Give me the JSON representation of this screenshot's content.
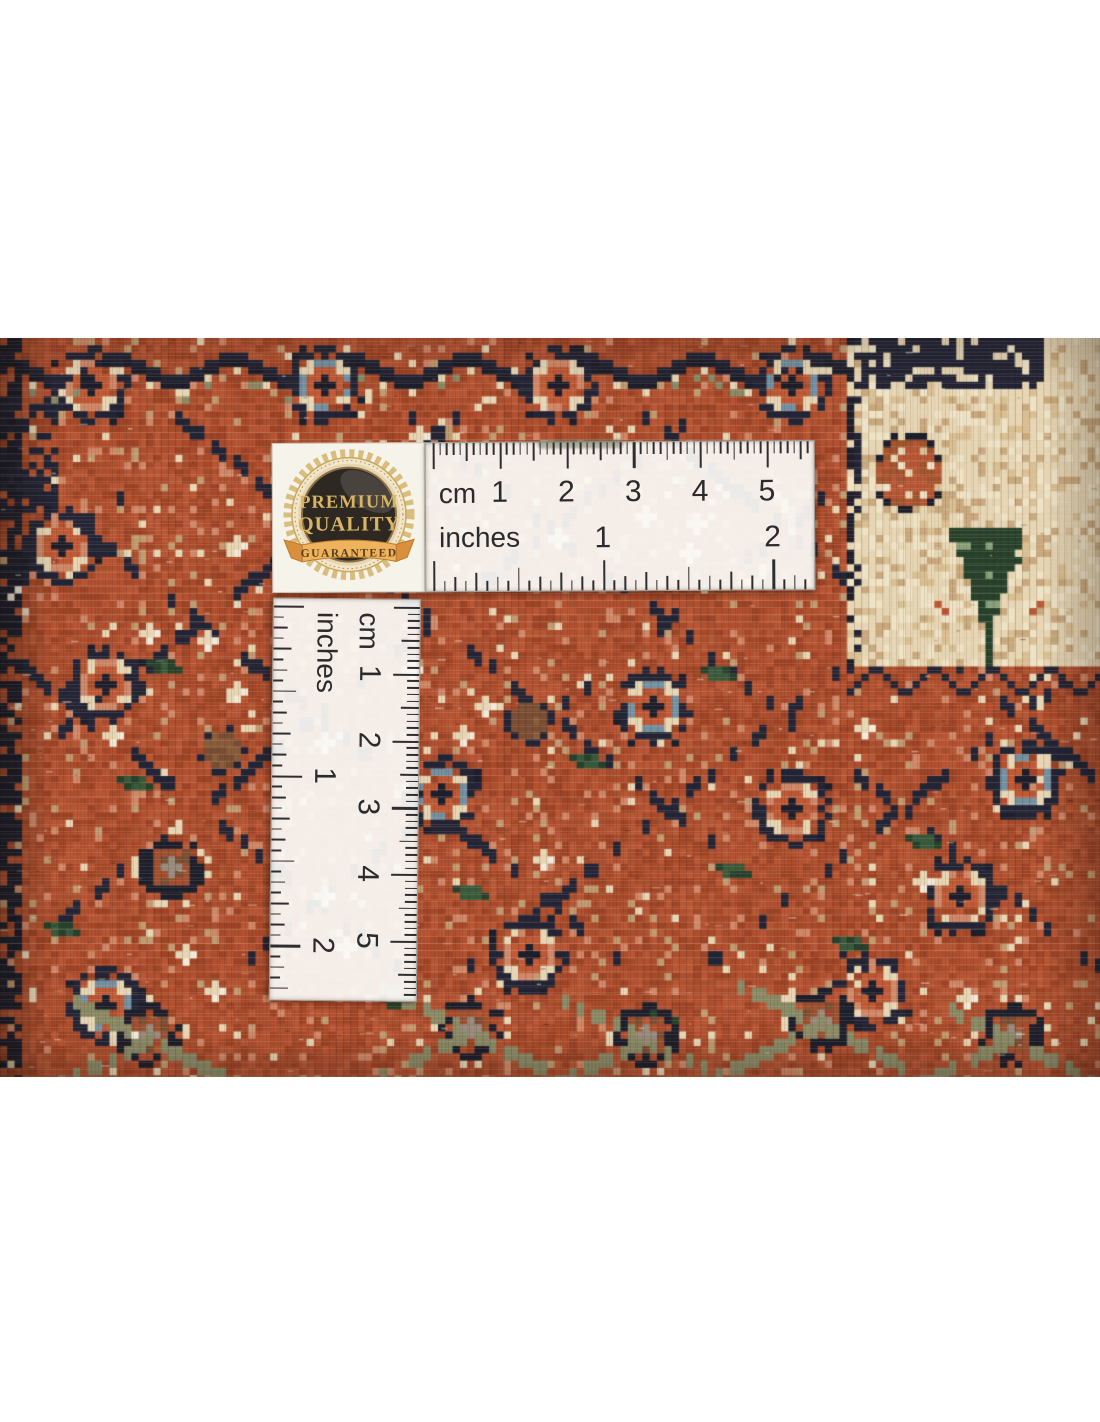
{
  "photo": {
    "description": "Close-up of a hand-knotted oriental wool rug in rust red, navy, cream and green, measured with an L-shaped ruler in centimetres and inches, with a Premium Quality Guaranteed badge",
    "badge": {
      "title_line1": "PREMIUM",
      "title_line2": "QUALITY",
      "ribbon_text": "GUARANTEED"
    },
    "ruler": {
      "cm_label": "cm",
      "inch_label": "inches",
      "cm_numbers": [
        "1",
        "2",
        "3",
        "4",
        "5"
      ],
      "inch_numbers": [
        "1",
        "2"
      ]
    },
    "colors": {
      "rug_rust": "#ac4c2c",
      "rug_navy": "#232536",
      "rug_cream": "#e7d6b4",
      "rug_green": "#3a5a3c",
      "ruler_plastic": "#f7f6f2",
      "badge_gold": "#d3a755"
    }
  }
}
